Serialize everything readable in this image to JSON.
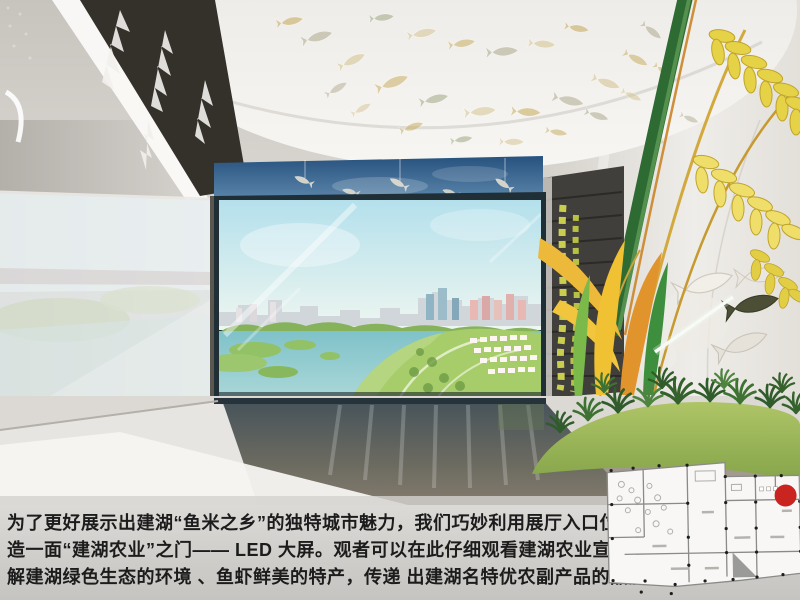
{
  "page": {
    "kind": "exhibition-hall-design-proposal-page",
    "hall_theme": "建湖农业"
  },
  "caption": {
    "lines": [
      "为了更好展示出建湖“鱼米之乡”的独特城市魅力，我们巧妙利用展厅入口位置，创新打",
      "造一面“建湖农业”之门—— LED 大屏。观者可以在此仔细观看建湖农业宣传片，更好了",
      "解建湖绿色生态的环境 、鱼虾鲜美的特产，传递  出建湖名特优农副产品的品牌特点。"
    ],
    "text_color": "#1c1c1c",
    "band_color": "#d2d0cd"
  },
  "scene_elements": [
    "ceiling-glass-fish-installation",
    "sky-mural-band",
    "led-screen-lake-city-aerial",
    "left-wall-reflection-panel",
    "dark-slat-panel",
    "rice-wheat-sculpture",
    "hanging-grain-strands",
    "leaf-sculptures",
    "grass-mound",
    "wall-fish-reliefs",
    "glossy-floor"
  ],
  "palette": {
    "screen_sky": "#bce3ec",
    "screen_water": "#82c4ca",
    "screen_green": "#a6cd69",
    "sky_mural_blue": "#2c5a88",
    "rice_gold": "#e6d247",
    "leaf_orange": "#e1932c",
    "leaf_green": "#3e8f3d",
    "grass_mound_green": "#9cba5c",
    "floor_reflection": "#55605f",
    "marker_red": "#c92420"
  },
  "floor_plan": {
    "marker_color": "#c92420",
    "paper_color": "#f8f7f5"
  }
}
